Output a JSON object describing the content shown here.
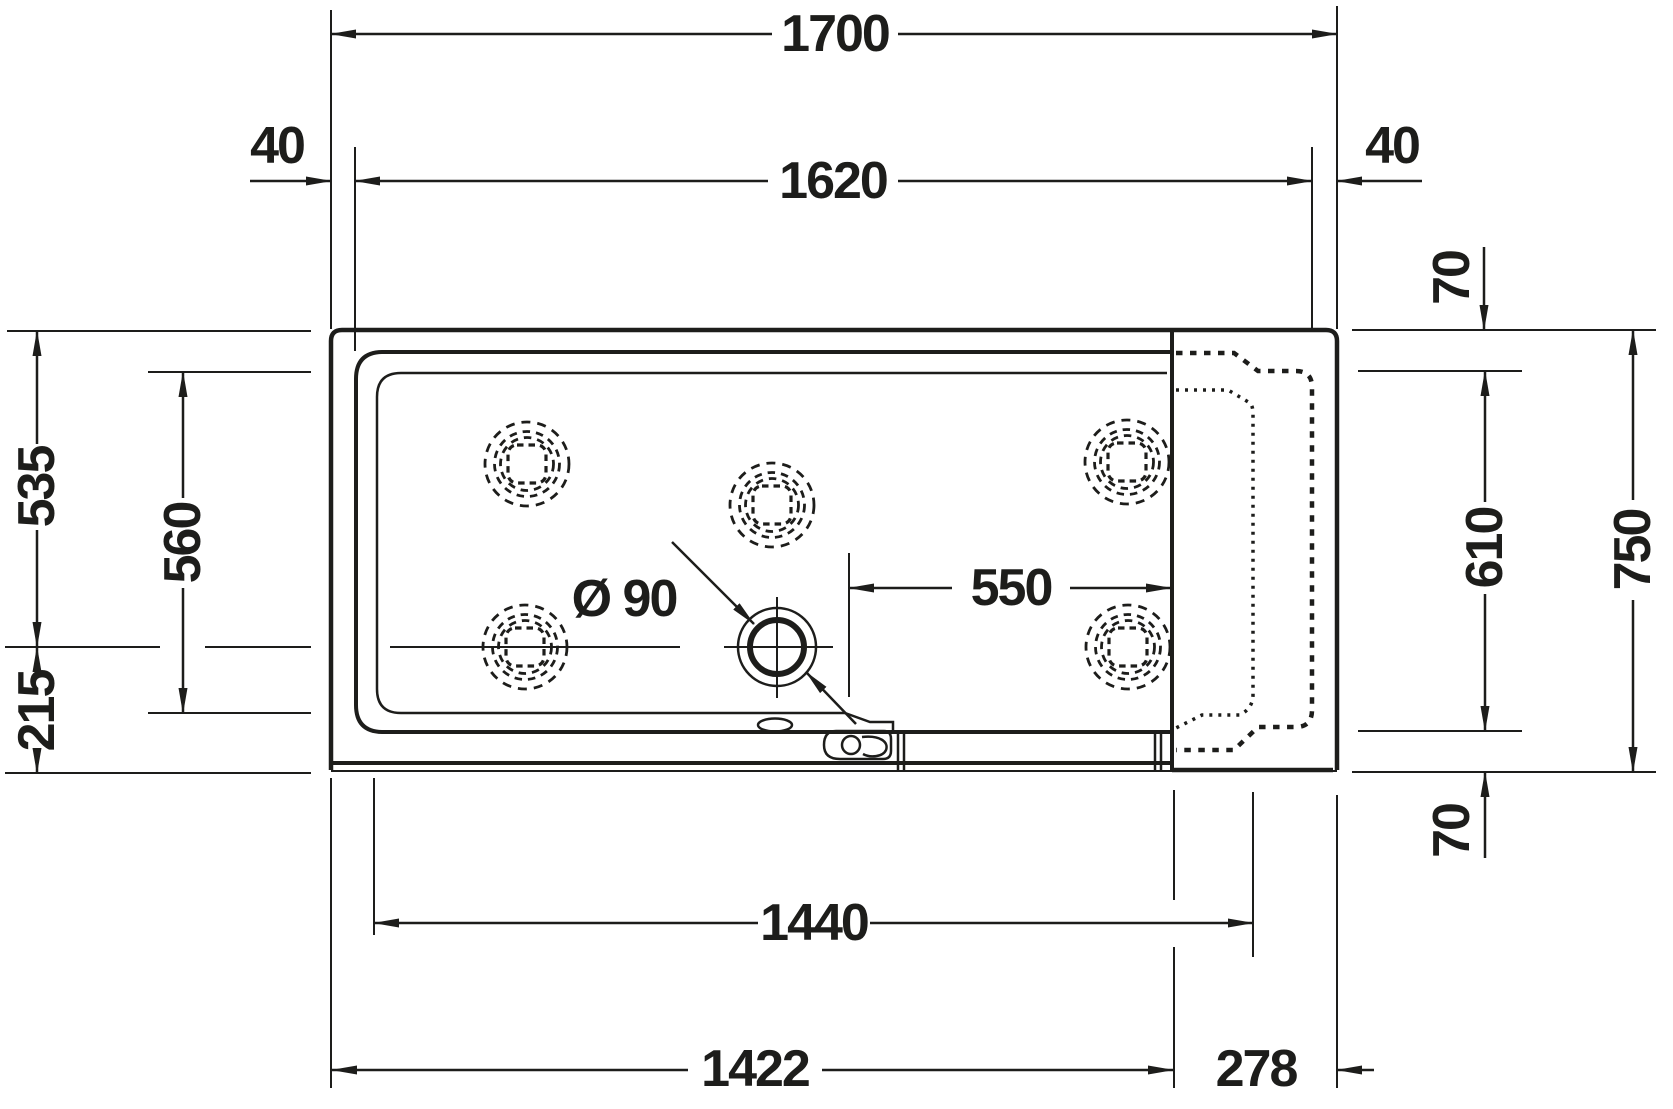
{
  "drawing": {
    "line_color": "#1d1d1b",
    "background_color": "#ffffff",
    "dimensions": {
      "d1700": "1700",
      "d1620": "1620",
      "d40_left": "40",
      "d40_right": "40",
      "d70_top": "70",
      "d535": "535",
      "d560": "560",
      "d215": "215",
      "d610": "610",
      "d750": "750",
      "d70_bottom": "70",
      "d550": "550",
      "drain_diameter": "Ø 90",
      "d1440": "1440",
      "d1422": "1422",
      "d278": "278"
    }
  }
}
